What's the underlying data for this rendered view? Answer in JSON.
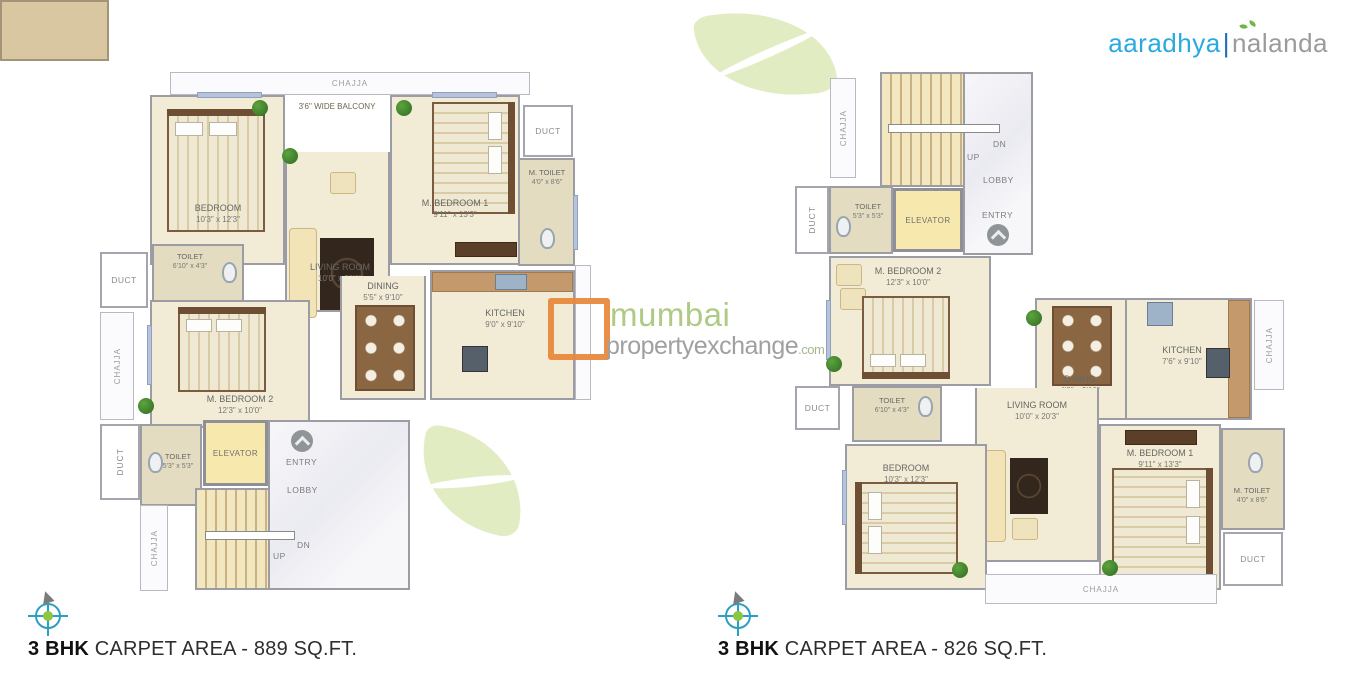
{
  "logo": {
    "brand": "aaradhya",
    "divider": "|",
    "sub": "nalanda"
  },
  "watermark": {
    "name": "mumbai",
    "name2": "propertyexchange",
    "tld": ".com"
  },
  "colors": {
    "brand_blue": "#29a9e1",
    "logo_gray": "#9c9b9b",
    "leaf_green": "#e1ecc3",
    "watermark_green": "#abc87e",
    "watermark_gray": "#9b9b9b",
    "watermark_orange": "#e98a3e",
    "compass_teal": "#2d9fc2",
    "compass_green": "#8dc63f",
    "floor_beige": "#f2ecd6"
  },
  "plans": {
    "left": {
      "caption": {
        "bold": "3 BHK",
        "rest": " CARPET AREA - 889 SQ.FT."
      },
      "rooms": {
        "chajja_top": "CHAJJA",
        "balcony": "3'6\" WIDE BALCONY",
        "bedroom": {
          "name": "BEDROOM",
          "dim": "10'3\" x 12'3\""
        },
        "m_bedroom1": {
          "name": "M. BEDROOM 1",
          "dim": "9'11\" x 13'3\""
        },
        "duct_top": "DUCT",
        "m_toilet": {
          "name": "M. TOILET",
          "dim": "4'0\" x 8'6\""
        },
        "toilet_top": {
          "name": "TOILET",
          "dim": "6'10\" x 4'3\""
        },
        "duct_left": "DUCT",
        "chajja_left": "CHAJJA",
        "living": {
          "name": "LIVING ROOM",
          "dim": "10'0\" x 20'0\""
        },
        "dining": {
          "name": "DINING",
          "dim": "5'5\" x 9'10\""
        },
        "kitchen": {
          "name": "KITCHEN",
          "dim": "9'0\" x 9'10\""
        },
        "m_bedroom2": {
          "name": "M. BEDROOM 2",
          "dim": "12'3\" x 10'0\""
        },
        "duct_bottom": "DUCT",
        "toilet_bottom": {
          "name": "TOILET",
          "dim": "5'3\" x 5'3\""
        },
        "elevator": "ELEVATOR",
        "entry": "ENTRY",
        "lobby": "LOBBY",
        "up": "UP",
        "dn": "DN",
        "chajja_stair": "CHAJJA"
      }
    },
    "right": {
      "caption": {
        "bold": "3 BHK",
        "rest": " CARPET AREA - 826 SQ.FT."
      },
      "rooms": {
        "chajja_top": "CHAJJA",
        "up": "UP",
        "dn": "DN",
        "lobby": "LOBBY",
        "entry": "ENTRY",
        "elevator": "ELEVATOR",
        "duct_top": "DUCT",
        "toilet_top": {
          "name": "TOILET",
          "dim": "5'3\" x 5'3\""
        },
        "m_bedroom2": {
          "name": "M. BEDROOM 2",
          "dim": "12'3\" x 10'0\""
        },
        "toilet_mid": {
          "name": "TOILET",
          "dim": "6'10\" x 4'3\""
        },
        "duct_left": "DUCT",
        "dining": {
          "name": "DINING",
          "dim": "4'0\" x 9'10\""
        },
        "kitchen": {
          "name": "KITCHEN",
          "dim": "7'6\" x 9'10\""
        },
        "chajja_right": "CHAJJA",
        "living": {
          "name": "LIVING ROOM",
          "dim": "10'0\" x 20'3\""
        },
        "bedroom": {
          "name": "BEDROOM",
          "dim": "10'3\" x 12'3\""
        },
        "m_bedroom1": {
          "name": "M. BEDROOM 1",
          "dim": "9'11\" x 13'3\""
        },
        "m_toilet": {
          "name": "M. TOILET",
          "dim": "4'0\" x 8'6\""
        },
        "duct_bottom": "DUCT",
        "chajja_bottom": "CHAJJA"
      }
    }
  }
}
